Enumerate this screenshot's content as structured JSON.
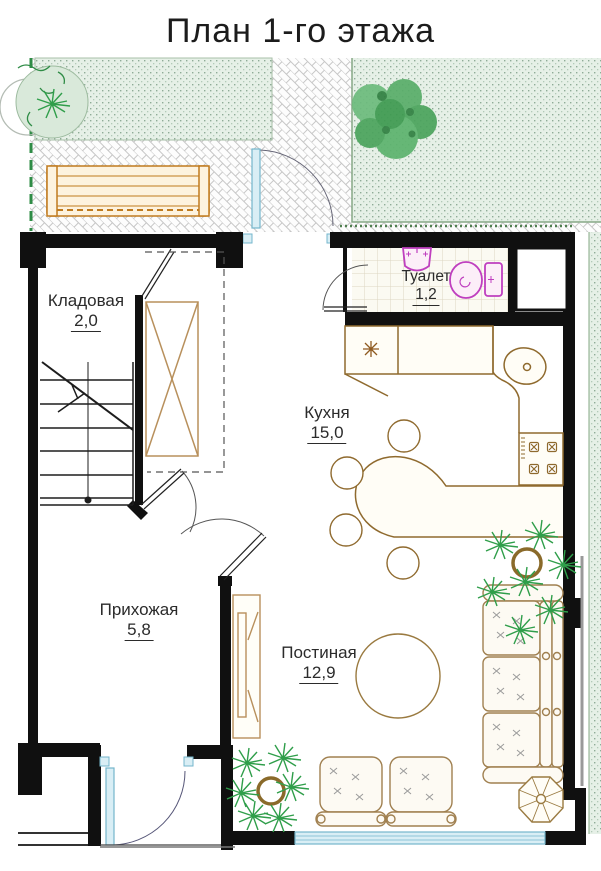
{
  "title": "План 1-го этажа",
  "rooms": {
    "storage": {
      "name": "Кладовая",
      "area": "2,0"
    },
    "toilet": {
      "name": "Туалет",
      "area": "1,2"
    },
    "kitchen": {
      "name": "Кухня",
      "area": "15,0"
    },
    "hall": {
      "name": "Прихожая",
      "area": "5,8"
    },
    "living": {
      "name": "Постиная",
      "area": "12,9"
    }
  },
  "colors": {
    "wall": "#101010",
    "furniture_wood": "#8f6a2e",
    "bench_wood": "#c07b1e",
    "plumbing_fixture": "#bf3fbf",
    "glazing": "#74b6cc",
    "lawn": "#e6f0e7",
    "foliage": "#2f9e4a",
    "pot": "#8a6a2a"
  }
}
